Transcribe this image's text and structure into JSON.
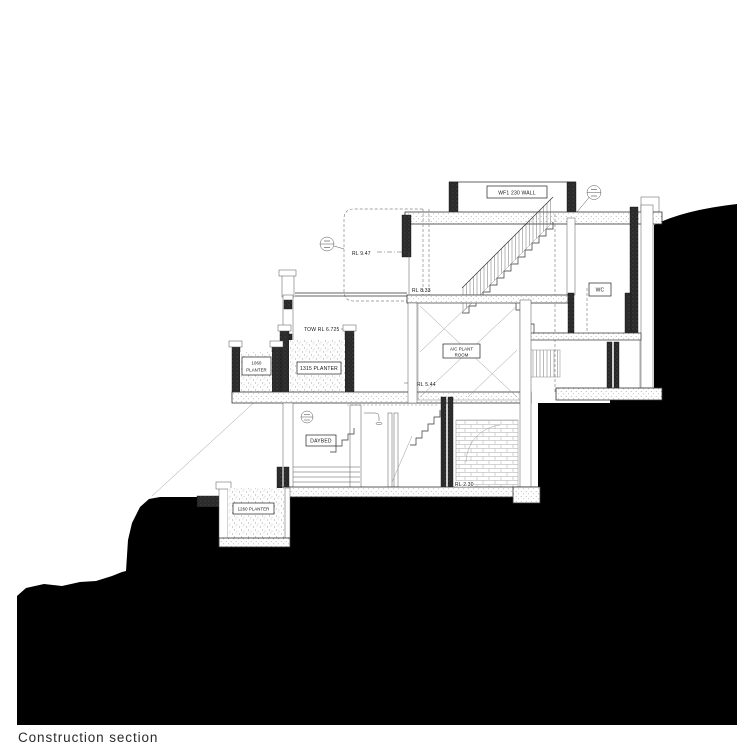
{
  "page": {
    "width": 750,
    "height": 750,
    "background": "#ffffff",
    "caption": "Construction section"
  },
  "colors": {
    "ground_fill": "#000000",
    "ink": "#1c1c1c",
    "line_gray": "#555555",
    "dashed_gray": "#888888"
  },
  "annotations": {
    "wall_tag": "WF1 230 WALL",
    "rl_roof": "RL 9.47",
    "rl_upper": "RL 8.33",
    "tow": "TOW RL 6.725",
    "rl_mid": "RL 5.44",
    "rl_lower": "RL 2.30",
    "wc": "WC",
    "ac_room_line1": "A/C PLANT",
    "ac_room_line2": "ROOM",
    "daybed": "DAYBED",
    "planter_1315": "1315 PLANTER",
    "planter_1060_line1": "1060",
    "planter_1060_line2": "PLANTER",
    "planter_1260": "1260 PLANTER"
  }
}
